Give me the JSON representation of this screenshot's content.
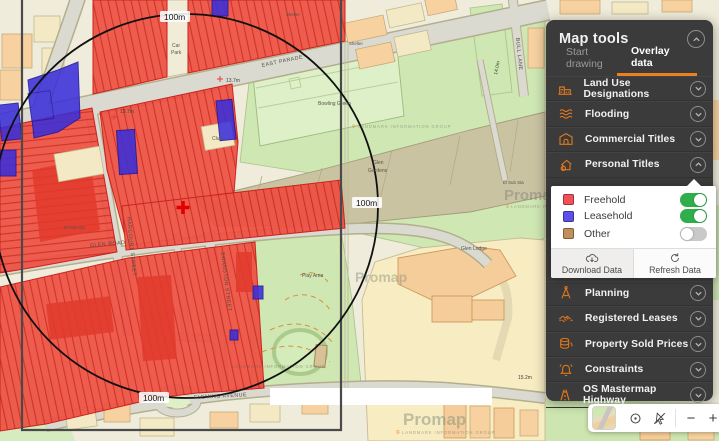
{
  "map": {
    "scale_labels": {
      "top": "100m",
      "right": "100m",
      "bottom": "100m"
    },
    "street_labels": {
      "east_parade": "EAST PARADE",
      "glen_road": "GLEN ROAD",
      "harcourt_street": "HARCOURT STREET",
      "swanston_street": "SWANSTON STREET",
      "fleming_avenue": "FLEMING AVENUE",
      "bull_lane": "BULL LANE"
    },
    "place_labels": {
      "car_park_1": "Car",
      "car_park_2": "Park",
      "bowling_green": "Bowling Green",
      "glen_gardens_1": "Glen",
      "glen_gardens_2": "Gardens",
      "glen_lodge": "Glen Lodge",
      "play_area": "Play Area",
      "el_sub_sta": "El Sub Sta",
      "el_sub_sta_2": "El Sub Sta",
      "club": "Club",
      "shelter": "Shelter",
      "shelter_2": "Shelter"
    },
    "spot_heights": {
      "a": "13.7m",
      "b": "13.7m",
      "c": "15.2m",
      "d": "14.0m"
    },
    "watermark_brand": "Promap",
    "watermark_copyright": "©",
    "watermark_attribution": "LANDMARK INFORMATION GROUP",
    "colors": {
      "freehold": "#ee5043",
      "leasehold": "#3b2fd9",
      "other": "#c08f5b",
      "accent": "#e8831f"
    }
  },
  "panel": {
    "title": "Map tools",
    "tabs": [
      {
        "label": "Start drawing",
        "active": false
      },
      {
        "label": "Overlay data",
        "active": true
      }
    ],
    "sections": [
      {
        "label": "Land Use Designations",
        "expanded": false
      },
      {
        "label": "Flooding",
        "expanded": false
      },
      {
        "label": "Commercial Titles",
        "expanded": false
      },
      {
        "label": "Personal Titles",
        "expanded": true
      },
      {
        "label": "Planning",
        "expanded": false
      },
      {
        "label": "Registered Leases",
        "expanded": false
      },
      {
        "label": "Property Sold Prices",
        "expanded": false
      },
      {
        "label": "Constraints",
        "expanded": false
      },
      {
        "label": "OS Mastermap Highway",
        "expanded": false
      }
    ],
    "personal_titles": {
      "layers": [
        {
          "label": "Freehold",
          "swatch": "#f4505a",
          "enabled": true
        },
        {
          "label": "Leasehold",
          "swatch": "#5b50e8",
          "enabled": true
        },
        {
          "label": "Other",
          "swatch": "#c08f5b",
          "enabled": false
        }
      ],
      "download_label": "Download Data",
      "refresh_label": "Refresh Data"
    }
  },
  "toolbar": {
    "zoom_out": "−",
    "zoom_in": "+"
  }
}
